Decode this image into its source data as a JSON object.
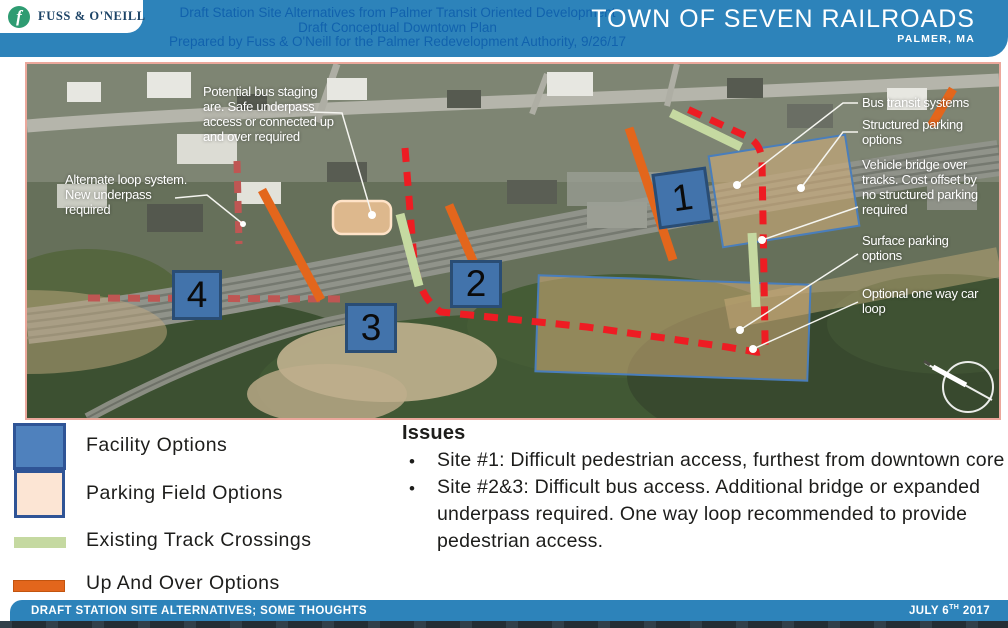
{
  "header": {
    "logo": {
      "monogram": "f",
      "name": "FUSS & O'NEILL"
    },
    "subtitle_lines": [
      "Draft Station Site Alternatives from Palmer Transit Oriented Development",
      "Draft Conceptual Downtown Plan",
      "Prepared by Fuss & O'Neill for the Palmer Redevelopment Authority, 9/26/17"
    ],
    "title": "TOWN OF SEVEN RAILROADS",
    "location": "PALMER, MA"
  },
  "map": {
    "markers": [
      {
        "label": "1"
      },
      {
        "label": "2"
      },
      {
        "label": "3"
      },
      {
        "label": "4"
      }
    ],
    "callouts": {
      "potential_bus": "Potential bus staging are.  Safe underpass access or connected up and over required",
      "alternate_loop": "Alternate loop system.  New underpass required",
      "bus_transit": "Bus transit systems",
      "structured_parking": "Structured parking options",
      "vehicle_bridge": "Vehicle bridge over tracks.  Cost offset by no structured parking required",
      "surface_parking": "Surface parking options",
      "one_way_loop": "Optional one way car loop"
    },
    "compass": "north-arrow"
  },
  "legend": {
    "items": [
      {
        "label": "Facility Options",
        "swatch": "facility"
      },
      {
        "label": "Parking Field Options",
        "swatch": "parking-field"
      },
      {
        "label": "Existing Track Crossings",
        "swatch": "track-crossing"
      },
      {
        "label": "Up And Over Options",
        "swatch": "up-and-over"
      }
    ]
  },
  "issues": {
    "heading": "Issues",
    "bullets": [
      "Site #1:  Difficult pedestrian access, furthest from downtown core",
      "Site #2&3: Difficult bus access.  Additional bridge or expanded underpass required.  One way loop recommended to provide pedestrian access."
    ]
  },
  "footer": {
    "left_title": "DRAFT STATION SITE ALTERNATIVES; SOME THOUGHTS",
    "date_prefix": "JULY 6",
    "date_sup": "TH",
    "date_year": " 2017"
  },
  "colors": {
    "header_blue": "#2d83ba",
    "facility_fill": "#4f81bd",
    "parking_field_fill": "#fce5d4",
    "track_crossing_green": "#c5d9a1",
    "up_and_over_orange": "#e3661c",
    "main_loop_red": "#ee1c23",
    "alternate_loop_red": "#bf5653"
  }
}
